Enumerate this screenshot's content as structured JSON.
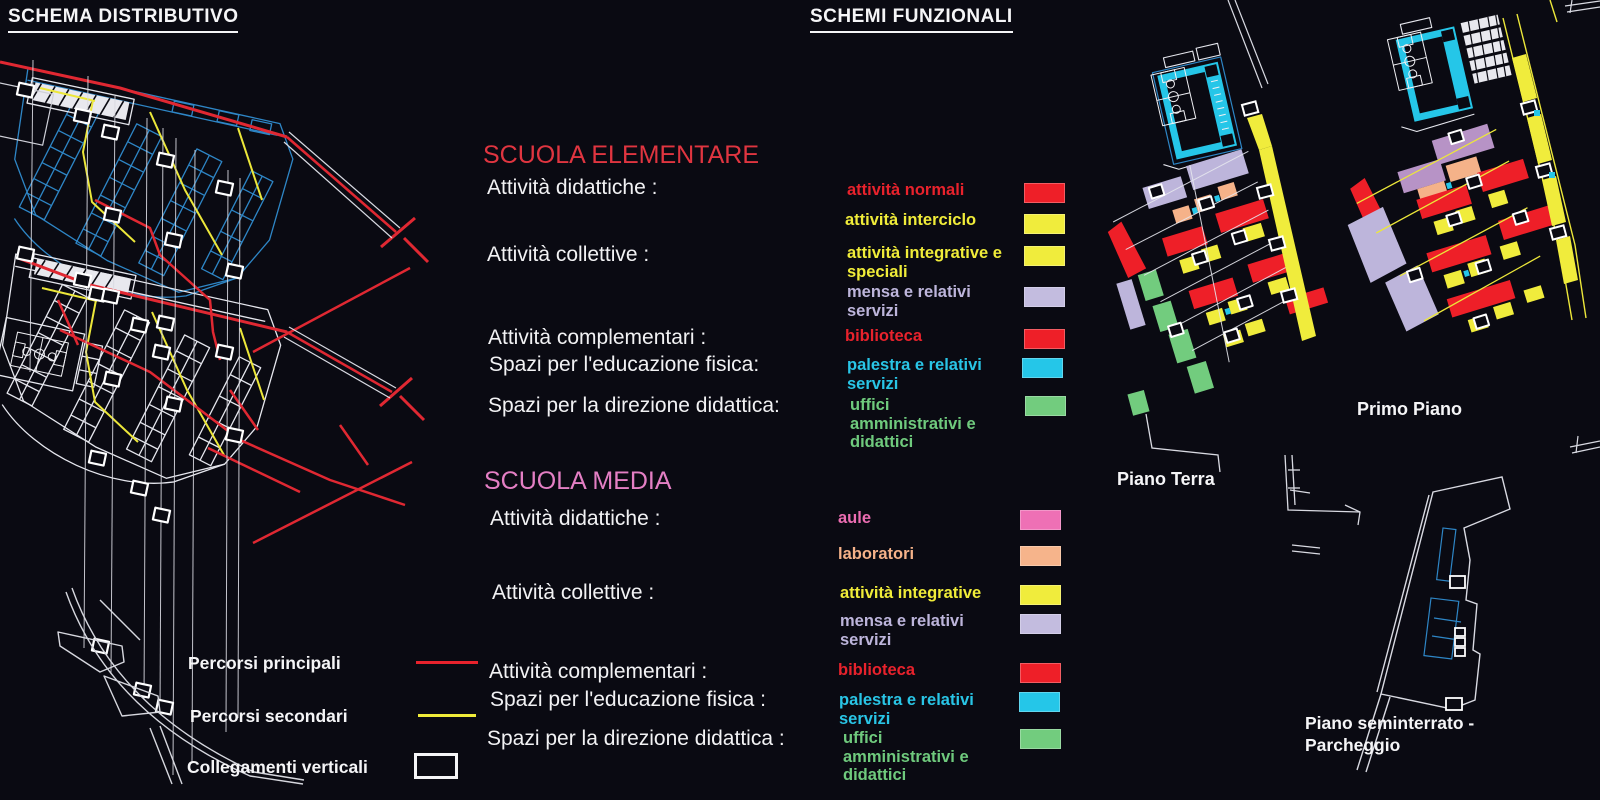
{
  "titles": {
    "left": "SCHEMA DISTRIBUTIVO",
    "right": "SCHEMI FUNZIONALI"
  },
  "colors": {
    "background": "#0a0a12",
    "red": "#e8222c",
    "yellow": "#f0ec39",
    "lilac": "#bdb5db",
    "cyan": "#25c6e8",
    "green": "#6fca7d",
    "pink": "#ec6db2",
    "peach": "#f5b289",
    "violet": "#b793c6",
    "plan_blue": "#2e86c6",
    "plan_white": "#e6e7ee"
  },
  "sections": [
    {
      "id": "elementare",
      "title": "SCUOLA ELEMENTARE",
      "title_color": "#e03540",
      "categories": [
        {
          "label": "Attività didattiche :"
        },
        {
          "label": "Attività collettive :"
        },
        {
          "label": "Attività complementari :"
        },
        {
          "label": "Spazi per l'educazione fisica:"
        },
        {
          "label": "Spazi per la direzione didattica:"
        }
      ],
      "entries": [
        {
          "label": "attività normali",
          "text_color": "#e8222c",
          "swatch": "#ee1f28"
        },
        {
          "label": "attività interciclo",
          "text_color": "#f0ec39",
          "swatch": "#f0ec3c"
        },
        {
          "label": "attività integrative e speciali",
          "text_color": "#f0ec39",
          "swatch": "#f0ec3c"
        },
        {
          "label": "mensa e relativi servizi",
          "text_color": "#bdb5db",
          "swatch": "#c3bcdf"
        },
        {
          "label": "biblioteca",
          "text_color": "#e8222c",
          "swatch": "#ee1f28"
        },
        {
          "label": "palestra e relativi servizi",
          "text_color": "#29c5e6",
          "swatch": "#25c6e8"
        },
        {
          "label": "uffici amministrativi e didattici",
          "text_color": "#6fca7d",
          "swatch": "#72cc7e"
        }
      ]
    },
    {
      "id": "media",
      "title": "SCUOLA MEDIA",
      "title_color": "#e47fc4",
      "categories": [
        {
          "label": "Attività didattiche :"
        },
        {
          "label": "Attività collettive :"
        },
        {
          "label": "Attività complementari :"
        },
        {
          "label": "Spazi per l'educazione fisica :"
        },
        {
          "label": "Spazi per la direzione didattica :"
        }
      ],
      "entries": [
        {
          "label": "aule",
          "text_color": "#ec6db2",
          "swatch": "#ee70b5"
        },
        {
          "label": "laboratori",
          "text_color": "#f5b289",
          "swatch": "#f6b48b"
        },
        {
          "label": "attività integrative",
          "text_color": "#f0ec39",
          "swatch": "#f0ec3c"
        },
        {
          "label": "mensa e relativi servizi",
          "text_color": "#bdb5db",
          "swatch": "#c3bcdf"
        },
        {
          "label": "biblioteca",
          "text_color": "#e8222c",
          "swatch": "#ee1f28"
        },
        {
          "label": "palestra e relativi servizi",
          "text_color": "#29c5e6",
          "swatch": "#25c6e8"
        },
        {
          "label": "uffici amministrativi e didattici",
          "text_color": "#6fca7d",
          "swatch": "#72cc7e"
        }
      ]
    }
  ],
  "path_legend": {
    "principali": {
      "label": "Percorsi principali",
      "color": "#e8222c"
    },
    "secondari": {
      "label": "Percorsi secondari",
      "color": "#f0ec39"
    },
    "collegamenti": {
      "label": "Collegamenti verticali",
      "color": "#ffffff"
    }
  },
  "floor_labels": {
    "piano_terra": "Piano Terra",
    "primo_piano": "Primo Piano",
    "seminterrato": "Piano seminterrato - Parcheggio"
  }
}
